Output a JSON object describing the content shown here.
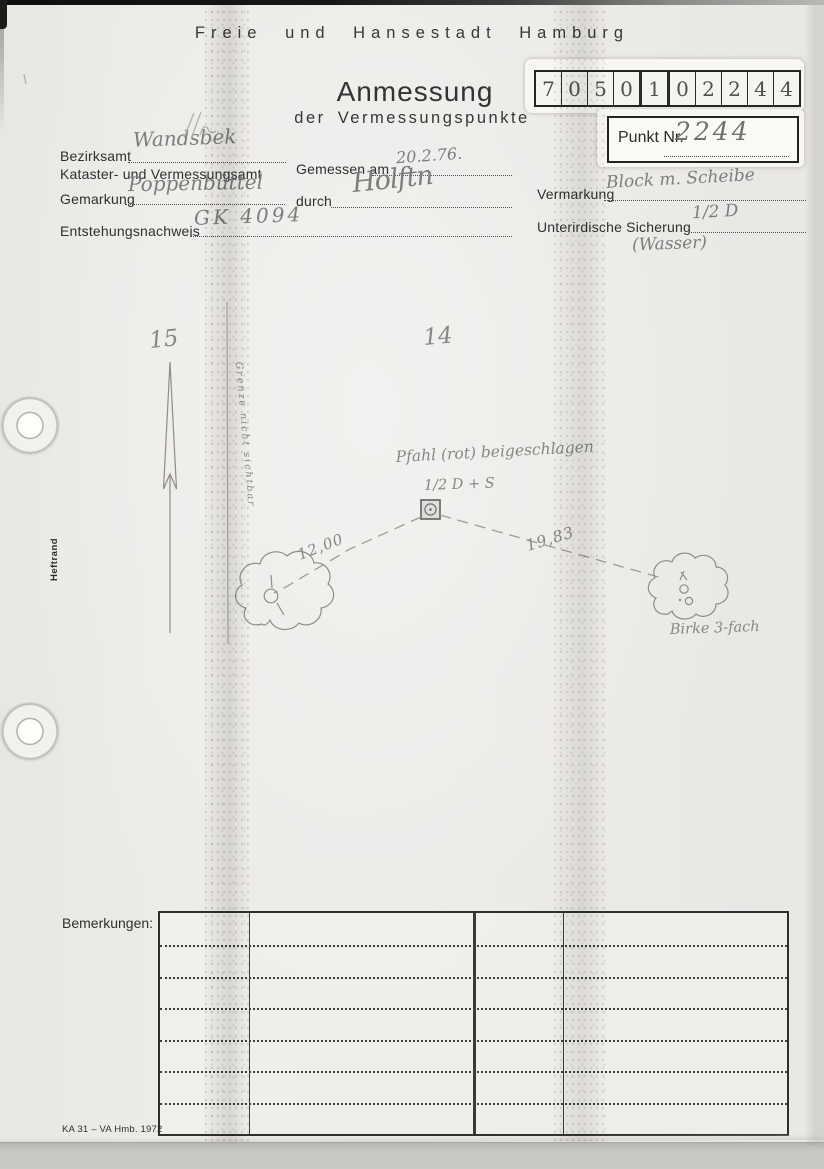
{
  "document": {
    "authority": "Freie und Hansestadt Hamburg",
    "title": "Anmessung",
    "subtitle": "der Vermessungspunkte",
    "form_code": "KA 31 – VA Hmb. 1972",
    "margin_label": "Heftrand",
    "remarks_label": "Bemerkungen:"
  },
  "point_code": {
    "digits": [
      "7",
      "0",
      "5",
      "0",
      "1",
      "0",
      "2",
      "2",
      "4",
      "4"
    ]
  },
  "punkt": {
    "label": "Punkt Nr.",
    "value": "2244"
  },
  "fields": {
    "bezirksamt_label": "Bezirksamt",
    "bezirksamt_label2": "Kataster- und Vermessungsamt",
    "bezirksamt_value": "Wandsbek",
    "gemessen_am_label": "Gemessen am",
    "gemessen_am_value": "20.2.76.",
    "gemarkung_label": "Gemarkung",
    "gemarkung_value": "Poppenbüttel",
    "durch_label": "durch",
    "durch_value": "Holftn",
    "vermarkung_label": "Vermarkung",
    "vermarkung_value": "Block m. Scheibe",
    "entstehungsnachweis_label": "Entstehungsnachweis",
    "sicherung_label": "Unterirdische Sicherung",
    "entstehungsnachweis_value": "GK 4094",
    "sicherung_value": "1/2 D",
    "sicherung_value2": "(Wasser)"
  },
  "sketch": {
    "parcel_left": "15",
    "parcel_right": "14",
    "boundary_note": "Grenze nicht sichtbar",
    "marker_note": "Pfahl (rot) beigeschlagen",
    "marker_type": "1/2 D + S",
    "distance_left": "12,00",
    "distance_right": "19,83",
    "tree_label": "Birke 3-fach"
  },
  "colors": {
    "paper": "#eceae7",
    "print_ink": "#2f2f2f",
    "pencil": "#7d7d7d",
    "scan_background": "#c9c7c4"
  }
}
